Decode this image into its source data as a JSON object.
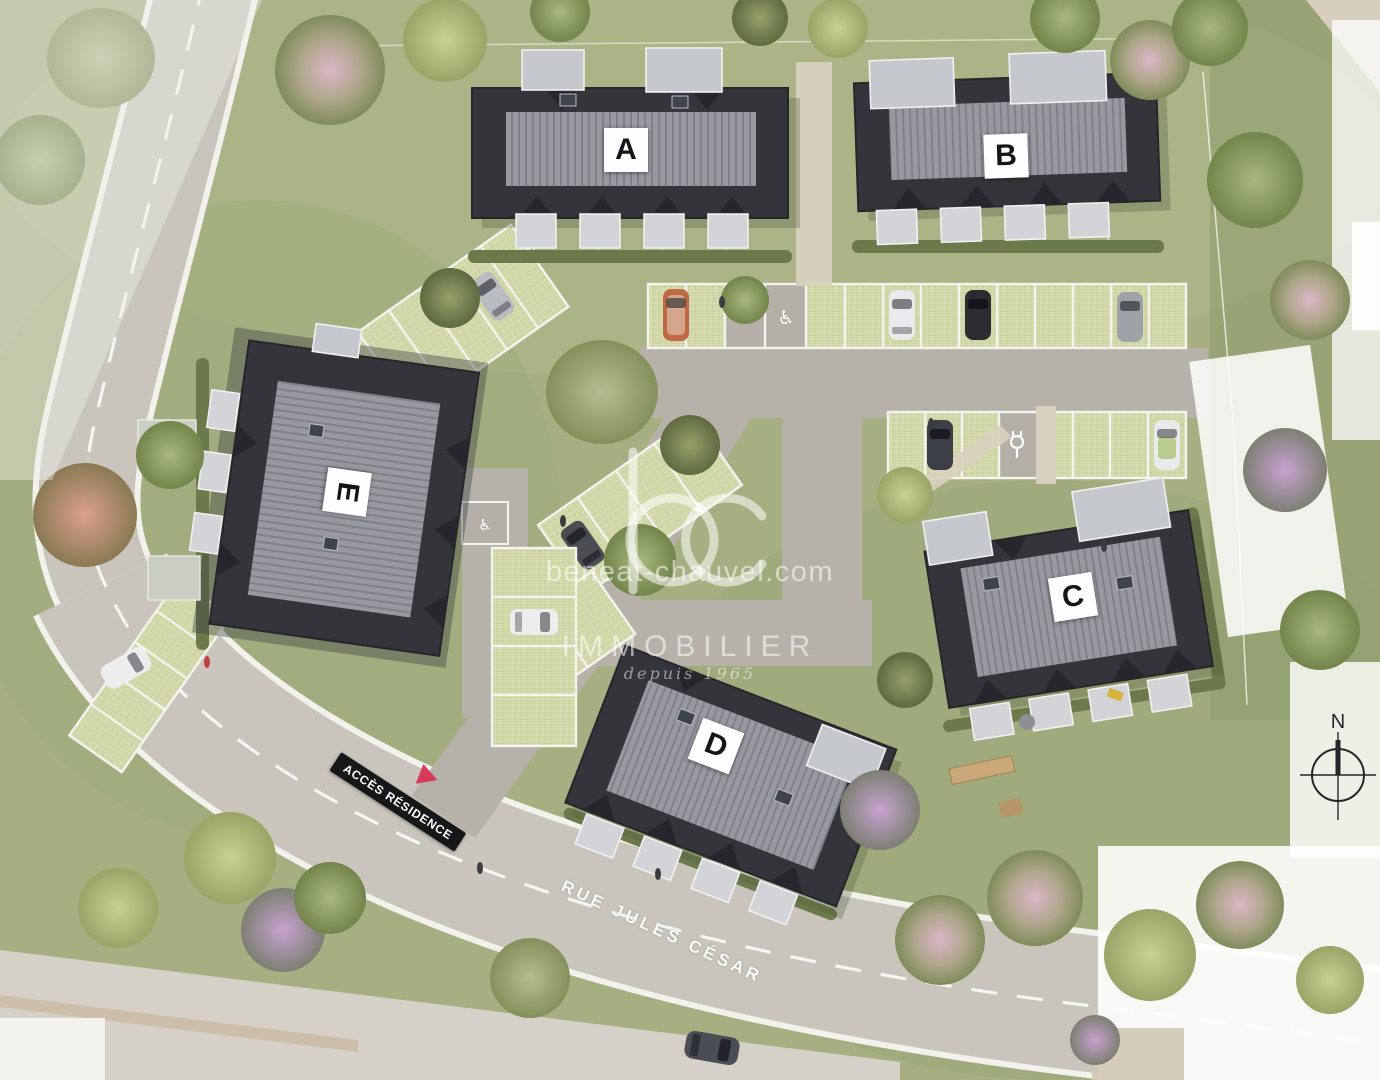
{
  "site_plan": {
    "buildings": [
      {
        "id": "building-a",
        "label": "A"
      },
      {
        "id": "building-b",
        "label": "B"
      },
      {
        "id": "building-c",
        "label": "C"
      },
      {
        "id": "building-d",
        "label": "D"
      },
      {
        "id": "building-e",
        "label": "E"
      }
    ],
    "access_sign": {
      "text": "ACCÈS RÉSIDENCE",
      "arrow_color": "#d9395a"
    },
    "street": {
      "name": "RUE JULES CÉSAR"
    },
    "compass": {
      "north": "N"
    },
    "markers": {
      "handicap": "♿"
    }
  },
  "watermark": {
    "logo_text": "bc",
    "website": "beneat-chauvel.com",
    "brand": "IMMOBILIER",
    "since": "depuis 1965"
  },
  "legend_colors": {
    "roof_dark": "#34353b",
    "roof_band": "#95979e",
    "grass": "#a5af82",
    "parking_grid": "#cbd29e",
    "road": "#c9c4bc",
    "asphalt": "#b6b1a9",
    "accent_red": "#d9395a"
  }
}
